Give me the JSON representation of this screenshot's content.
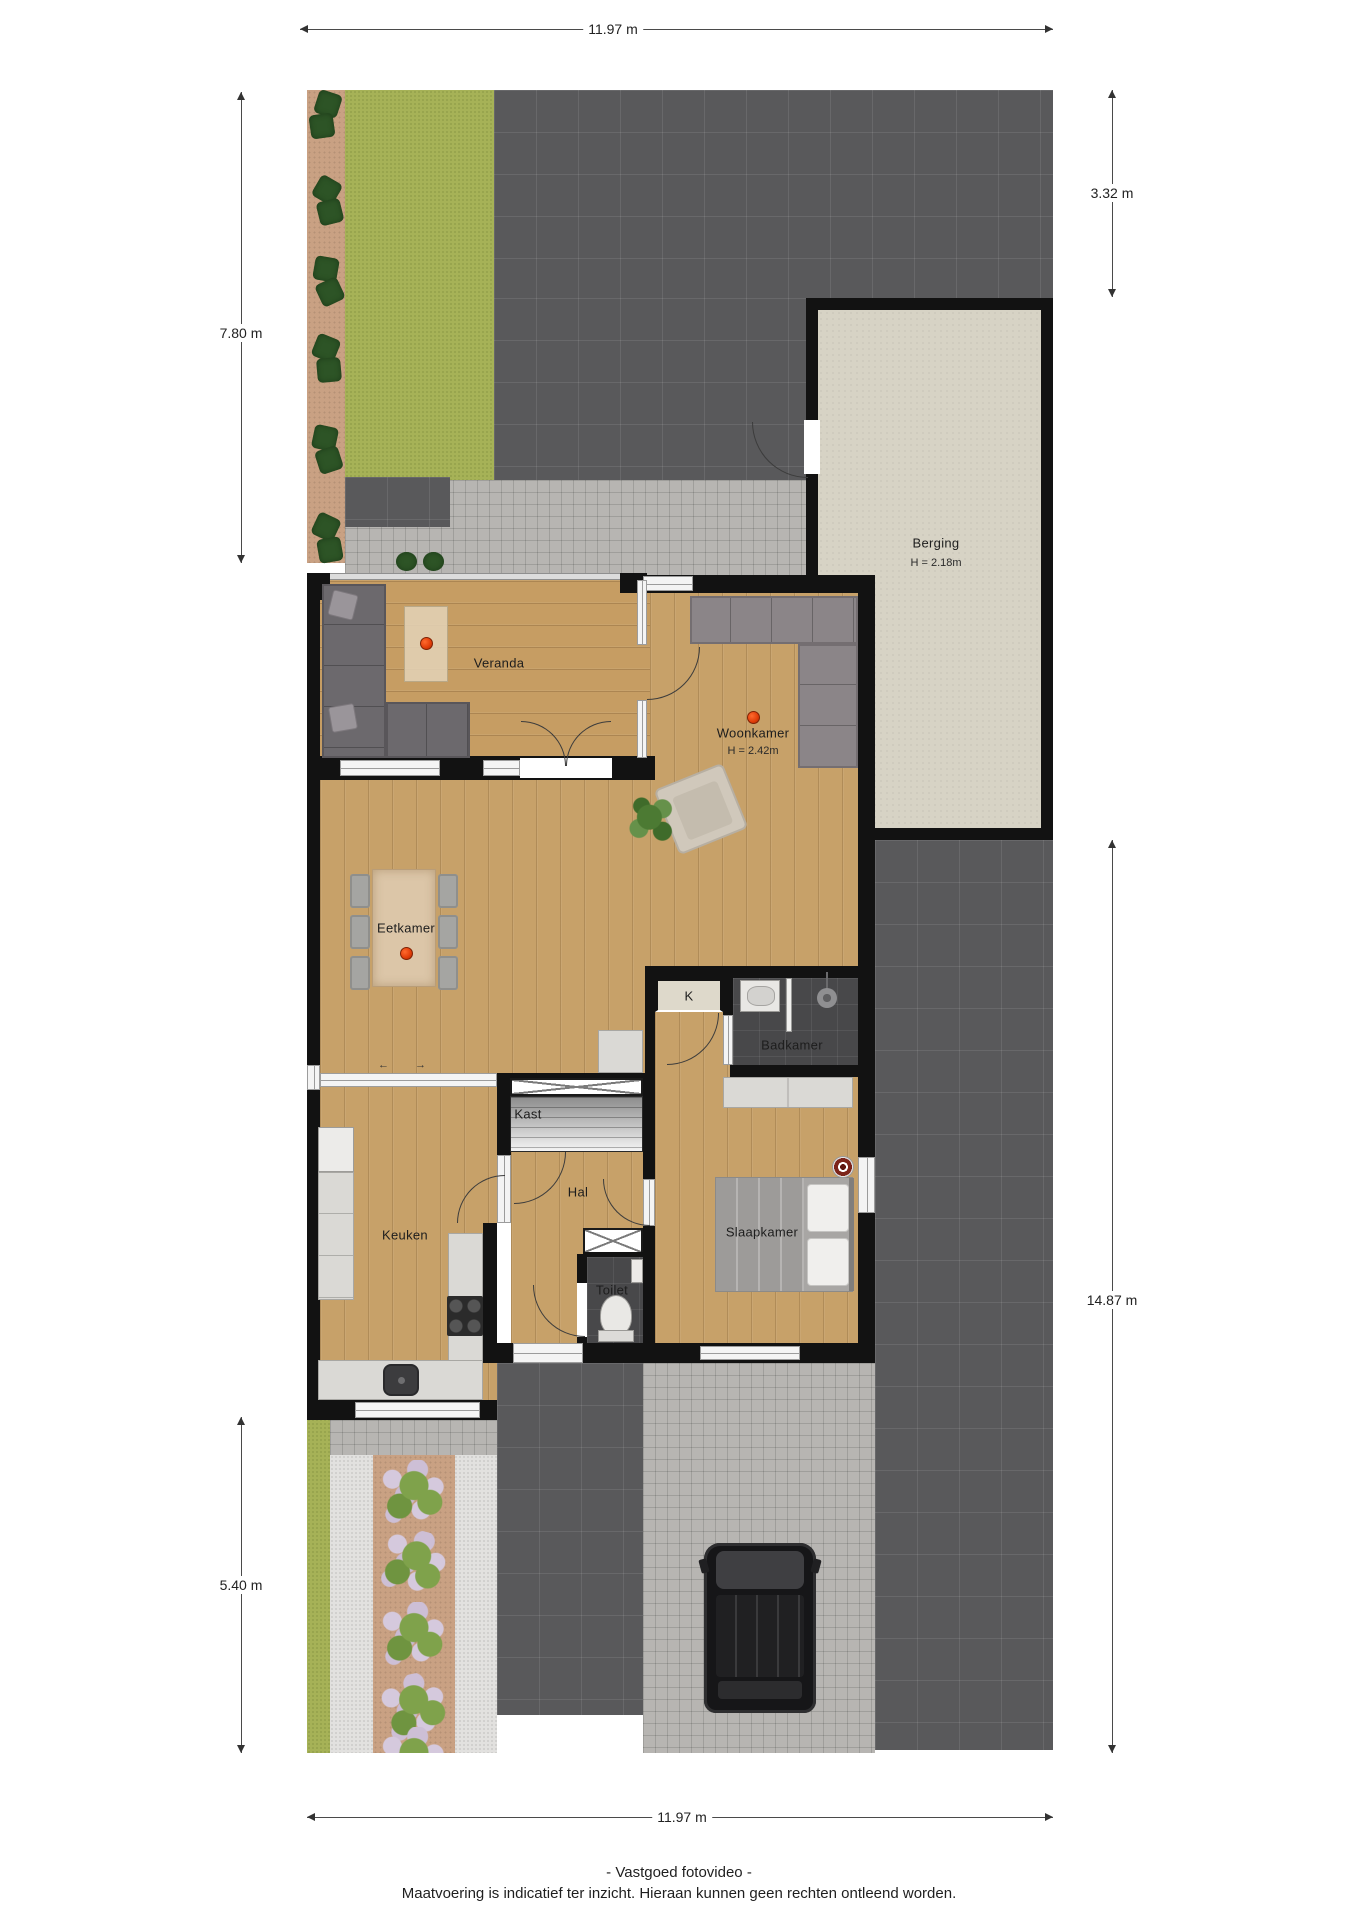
{
  "rooms": {
    "berging": {
      "label": "Berging",
      "height": "H = 2.18m"
    },
    "veranda": {
      "label": "Veranda"
    },
    "woonkamer": {
      "label": "Woonkamer",
      "height": "H = 2.42m"
    },
    "eetkamer": {
      "label": "Eetkamer"
    },
    "keuken": {
      "label": "Keuken"
    },
    "kast": {
      "label": "Kast"
    },
    "hal": {
      "label": "Hal"
    },
    "k_closet": {
      "label": "K"
    },
    "badkamer": {
      "label": "Badkamer"
    },
    "toilet": {
      "label": "Toilet"
    },
    "slaapkamer": {
      "label": "Slaapkamer"
    }
  },
  "dimensions": {
    "top": "11.97 m",
    "bottom": "11.97 m",
    "left_upper": "7.80 m",
    "left_lower": "5.40 m",
    "right_upper": "3.32 m",
    "right_lower": "14.87 m"
  },
  "footer": {
    "line1": "- Vastgoed fotovideo -",
    "line2": "Maatvoering is indicatief ter inzicht. Hieraan kunnen geen rechten ontleend worden."
  },
  "icons": {
    "slide_left": "←",
    "slide_right": "→"
  },
  "colors": {
    "marker_red": "#e03c08",
    "wall": "#121212",
    "wood_floor": "#c7a169",
    "berging_floor": "#d7d3c5",
    "dark_paving": "#59595b",
    "light_paving": "#b7b5b2",
    "grass": "#a6b257",
    "soil": "#c9a183",
    "bathroom_tile": "#48484a"
  }
}
